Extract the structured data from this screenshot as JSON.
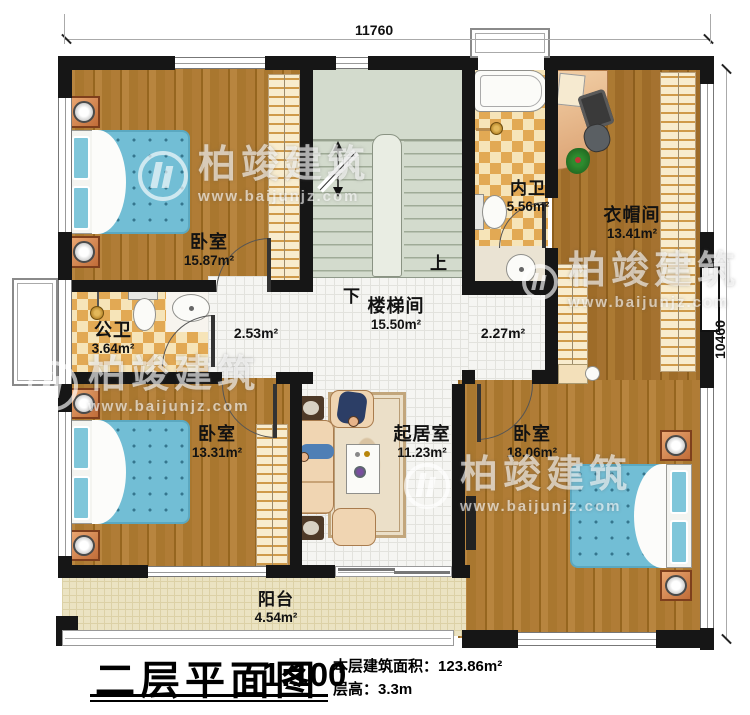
{
  "dimensions": {
    "top": "11760",
    "right": "10460"
  },
  "title_block": {
    "title": "二层平面图",
    "scale": "1:100",
    "area_label": "本层建筑面积：",
    "area_value": "123.86m²",
    "height_label": "层高：",
    "height_value": "3.3m"
  },
  "watermark": {
    "brand": "柏竣建筑",
    "url": "www.baijunjz.com"
  },
  "stairs": {
    "up": "上",
    "down": "下"
  },
  "rooms": {
    "bedroom_top_left": {
      "name": "卧室",
      "area": "15.87m²"
    },
    "inner_bath": {
      "name": "内卫",
      "area": "5.56m²"
    },
    "cloakroom": {
      "name": "衣帽间",
      "area": "13.41m²"
    },
    "public_bath": {
      "name": "公卫",
      "area": "3.64m²"
    },
    "stairwell": {
      "name": "楼梯间",
      "area": "15.50m²"
    },
    "bedroom_bottom_left": {
      "name": "卧室",
      "area": "13.31m²"
    },
    "living_room": {
      "name": "起居室",
      "area": "11.23m²"
    },
    "bedroom_bottom_right": {
      "name": "卧室",
      "area": "18.06m²"
    },
    "balcony": {
      "name": "阳台",
      "area": "4.54m²"
    }
  },
  "hallway": {
    "left_area": "2.53m²",
    "right_area": "2.27m²"
  }
}
